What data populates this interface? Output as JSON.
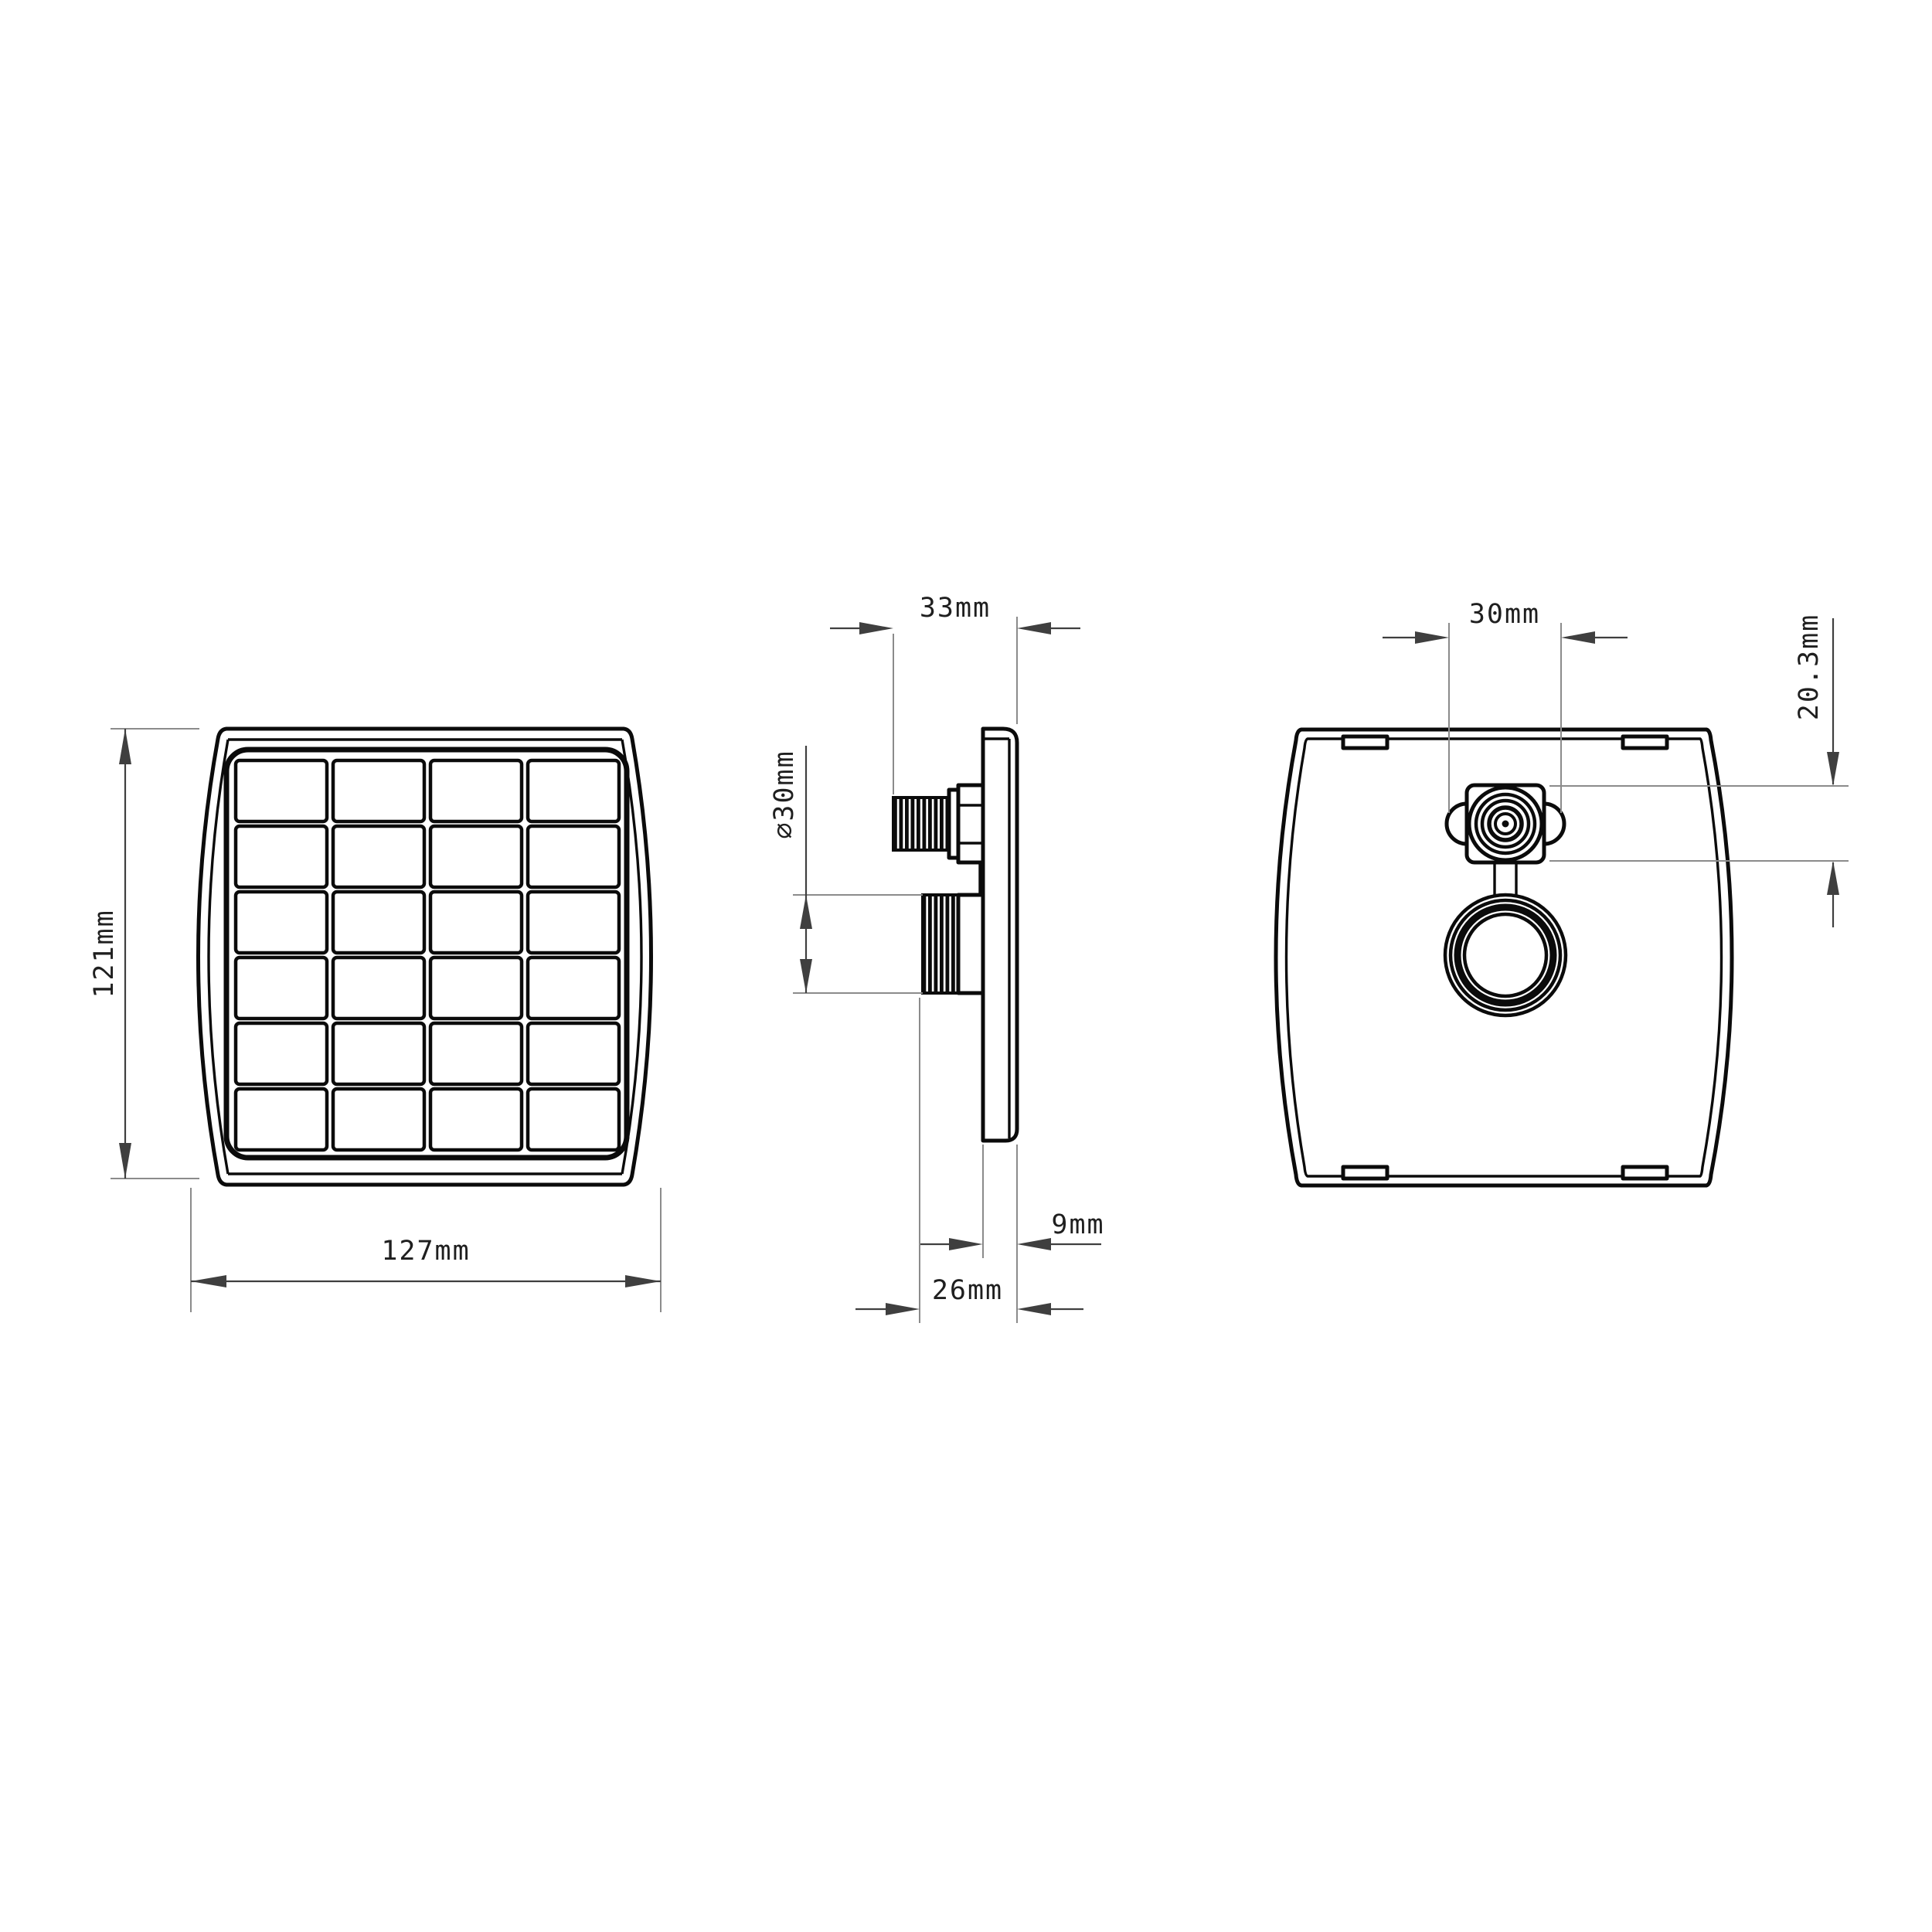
{
  "drawing": {
    "type": "technical-orthographic-drawing",
    "subject": "square solar panel with threaded mount connector",
    "views": [
      "front",
      "side",
      "back"
    ]
  },
  "front": {
    "grid": {
      "rows": 6,
      "cols": 4
    },
    "labels": {
      "height": "121mm",
      "width": "127mm"
    }
  },
  "side": {
    "labels": {
      "depth": "33mm",
      "diameter": "⌀30mm",
      "plate": "9mm",
      "body": "26mm"
    }
  },
  "back": {
    "labels": {
      "width": "30mm",
      "height": "20.3mm"
    }
  },
  "colors": {
    "line": "#0b0b0b",
    "extension": "#8b8b8b",
    "dimension": "#3f3f3f",
    "text": "#1f1f1f",
    "background": "#ffffff"
  }
}
